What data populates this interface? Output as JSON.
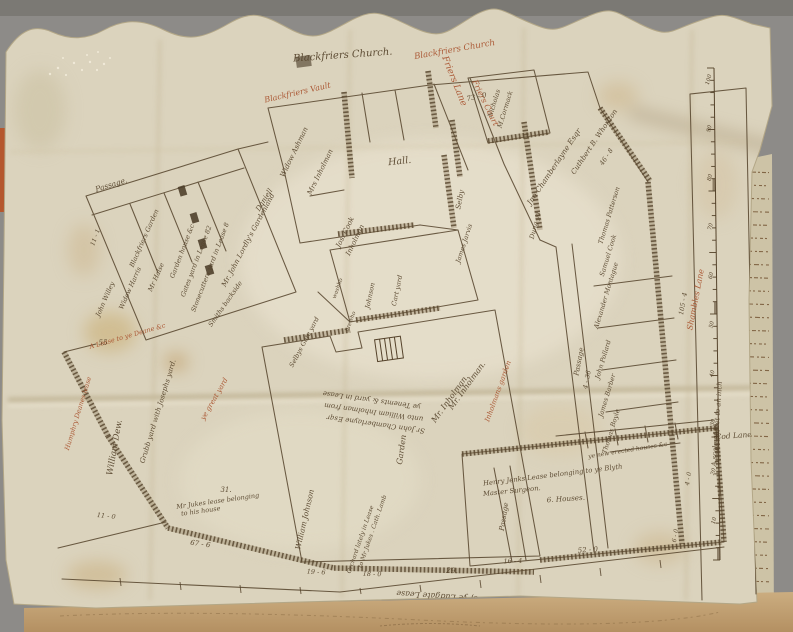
{
  "palette": {
    "backdrop": "#8d8b88",
    "backdrop_top": "#7b7974",
    "parchment": "#dbd3bd",
    "parchment_light": "#e9e2cf",
    "ink": "#54422a",
    "red": "#a8502c",
    "manuscript_paper": "#cdc3a6",
    "manuscript_ink": "#6a4826",
    "bottom_strip": "#c2a377",
    "red_sliver": "#b5572e"
  },
  "map": {
    "title": "Blackfriers Church.",
    "scale_bar": {
      "caption": "A scale of feet to an inch",
      "numbers": [
        "100",
        "90",
        "80",
        "70",
        "60",
        "50",
        "40",
        "30",
        "20",
        "10"
      ]
    },
    "labels": [
      {
        "id": "blackfriers-church-title",
        "text": "Blackfriers Church.",
        "x": 343,
        "y": 58,
        "r": -4,
        "s": 10,
        "c": "ink"
      },
      {
        "id": "blackfriers-vault-red",
        "text": "Blackfriers Vault",
        "x": 298,
        "y": 95,
        "r": -13,
        "s": 8,
        "c": "red"
      },
      {
        "id": "blackfriers-church-red",
        "text": "Blackfriers Church",
        "x": 455,
        "y": 52,
        "r": -10,
        "s": 8.5,
        "c": "red"
      },
      {
        "id": "friers-lane-red",
        "text": "Friers Lane",
        "x": 452,
        "y": 82,
        "r": 68,
        "s": 9,
        "c": "red"
      },
      {
        "id": "friers-court-red",
        "text": "Friers Court",
        "x": 483,
        "y": 104,
        "r": 64,
        "s": 8,
        "c": "red"
      },
      {
        "id": "hall-label",
        "text": "Hall.",
        "x": 400,
        "y": 164,
        "r": -6,
        "s": 9.5,
        "c": "ink"
      },
      {
        "id": "passage-top",
        "text": "Passage.",
        "x": 112,
        "y": 187,
        "r": -17,
        "s": 7.5,
        "c": "ink"
      },
      {
        "id": "measure-73-0",
        "text": "73 - 0",
        "x": 477,
        "y": 99,
        "r": -12,
        "s": 7,
        "c": "ink"
      },
      {
        "id": "nicholas",
        "text": "Nicholas",
        "x": 496,
        "y": 104,
        "r": -73,
        "s": 6.5,
        "c": "ink"
      },
      {
        "id": "mccormack",
        "text": "M.Cormack",
        "x": 507,
        "y": 110,
        "r": -73,
        "s": 6.5,
        "c": "ink"
      },
      {
        "id": "widow-ashman",
        "text": "Widow Ashman",
        "x": 296,
        "y": 153,
        "r": -64,
        "s": 7,
        "c": "ink"
      },
      {
        "id": "mrs-inholman",
        "text": "Mrs Inholman",
        "x": 322,
        "y": 173,
        "r": -64,
        "s": 7,
        "c": "ink"
      },
      {
        "id": "jos-cook",
        "text": "Jos. Cook",
        "x": 347,
        "y": 233,
        "r": -64,
        "s": 7,
        "c": "ink"
      },
      {
        "id": "inholman-2",
        "text": "Inholman",
        "x": 357,
        "y": 241,
        "r": -64,
        "s": 7,
        "c": "ink"
      },
      {
        "id": "blackfriers-garden",
        "text": "Blackfriers Garden",
        "x": 146,
        "y": 239,
        "r": -66,
        "s": 6.5,
        "c": "ink"
      },
      {
        "id": "room-willey",
        "text": "John Willey",
        "x": 107,
        "y": 300,
        "r": -66,
        "s": 6.5,
        "c": "ink"
      },
      {
        "id": "room-harris",
        "text": "Widow Harris",
        "x": 132,
        "y": 289,
        "r": -66,
        "s": 6.5,
        "c": "ink"
      },
      {
        "id": "room-halse",
        "text": "Mr Halse",
        "x": 158,
        "y": 278,
        "r": -66,
        "s": 6.5,
        "c": "ink"
      },
      {
        "id": "strip-gardenhouse",
        "text": "Garden house &c",
        "x": 184,
        "y": 252,
        "r": -69,
        "s": 6.5,
        "c": "ink"
      },
      {
        "id": "strip-gatesyard",
        "text": "Gates yard in Lease 82",
        "x": 198,
        "y": 262,
        "r": -69,
        "s": 6.5,
        "c": "ink"
      },
      {
        "id": "strip-stonecutters",
        "text": "Stonecutters yard in Lease 8",
        "x": 212,
        "y": 268,
        "r": -69,
        "s": 6.5,
        "c": "ink"
      },
      {
        "id": "lordly-gardenland",
        "text": "Mr. John Lordly's Gardenland",
        "x": 250,
        "y": 241,
        "r": -62,
        "s": 7,
        "c": "ink"
      },
      {
        "id": "daniell",
        "text": "Daniell",
        "x": 266,
        "y": 201,
        "r": -58,
        "s": 7,
        "c": "ink"
      },
      {
        "id": "measure-11-1",
        "text": "11 - 1",
        "x": 97,
        "y": 238,
        "r": -70,
        "s": 6,
        "c": "ink"
      },
      {
        "id": "chamberlayne",
        "text": "Jno Chamberlayne Esqr",
        "x": 556,
        "y": 168,
        "r": -56,
        "s": 7.5,
        "c": "ink"
      },
      {
        "id": "whorlton",
        "text": "Cuthbert B. Whorlton",
        "x": 596,
        "y": 143,
        "r": -56,
        "s": 7,
        "c": "ink"
      },
      {
        "id": "measure-46-8",
        "text": "46 - 8",
        "x": 608,
        "y": 158,
        "r": -56,
        "s": 6.5,
        "c": "ink"
      },
      {
        "id": "dung-yard",
        "text": "Dung yd",
        "x": 537,
        "y": 226,
        "r": -76,
        "s": 6.5,
        "c": "ink"
      },
      {
        "id": "selby",
        "text": "Selby",
        "x": 462,
        "y": 200,
        "r": -80,
        "s": 7,
        "c": "ink"
      },
      {
        "id": "james-jarvis",
        "text": "James Jarvis",
        "x": 466,
        "y": 244,
        "r": -72,
        "s": 6.5,
        "c": "ink"
      },
      {
        "id": "johnson",
        "text": "Johnson",
        "x": 372,
        "y": 296,
        "r": -78,
        "s": 6.5,
        "c": "ink"
      },
      {
        "id": "cart-yard",
        "text": "Cart yard",
        "x": 399,
        "y": 291,
        "r": -78,
        "s": 6.5,
        "c": "ink"
      },
      {
        "id": "washhouse",
        "text": "washho",
        "x": 339,
        "y": 289,
        "r": -70,
        "s": 5.5,
        "c": "ink"
      },
      {
        "id": "brewhouse",
        "text": "brewho",
        "x": 352,
        "y": 322,
        "r": -70,
        "s": 5.5,
        "c": "ink"
      },
      {
        "id": "gate-yard",
        "text": "Selbys Gate yard",
        "x": 306,
        "y": 343,
        "r": -62,
        "s": 6.5,
        "c": "ink"
      },
      {
        "id": "smiths-backside",
        "text": "Smiths backside",
        "x": 227,
        "y": 305,
        "r": -55,
        "s": 6.5,
        "c": "ink"
      },
      {
        "id": "lease-deane-red",
        "text": "A Lease to ye Deane &c",
        "x": 128,
        "y": 338,
        "r": -16,
        "s": 6.5,
        "c": "red"
      },
      {
        "id": "measure-55",
        "text": "55",
        "x": 103,
        "y": 345,
        "r": 0,
        "s": 7,
        "c": "ink"
      },
      {
        "id": "humphry-red",
        "text": "Humphry Deanes lease",
        "x": 80,
        "y": 414,
        "r": -73,
        "s": 6.5,
        "c": "red"
      },
      {
        "id": "william-dew",
        "text": "William Dew.",
        "x": 117,
        "y": 448,
        "r": -80,
        "s": 8.5,
        "c": "ink"
      },
      {
        "id": "grubb-yard",
        "text": "Grubb yard with Josephs yard.",
        "x": 160,
        "y": 412,
        "r": -73,
        "s": 7,
        "c": "ink"
      },
      {
        "id": "great-yard-red",
        "text": "ye great yard",
        "x": 216,
        "y": 400,
        "r": -60,
        "s": 7,
        "c": "red"
      },
      {
        "id": "measure-11-0",
        "text": "11 - 0",
        "x": 106,
        "y": 518,
        "r": 6,
        "s": 6.5,
        "c": "ink"
      },
      {
        "id": "jukes-lease-1",
        "text": "Mr Jukes lease belonging",
        "x": 218,
        "y": 503,
        "r": -8,
        "s": 6.5,
        "c": "ink"
      },
      {
        "id": "jukes-lease-2",
        "text": "to his house",
        "x": 201,
        "y": 513,
        "r": -8,
        "s": 6.5,
        "c": "ink"
      },
      {
        "id": "measure-31",
        "text": "31.",
        "x": 226,
        "y": 492,
        "r": 0,
        "s": 7,
        "c": "ink"
      },
      {
        "id": "garden-vertical",
        "text": "Garden",
        "x": 404,
        "y": 450,
        "r": -82,
        "s": 8,
        "c": "ink"
      },
      {
        "id": "mr-inholman-a",
        "text": "Mr. Inholman.",
        "x": 452,
        "y": 400,
        "r": -54,
        "s": 8,
        "c": "ink"
      },
      {
        "id": "mr-inholman-b",
        "text": "Mr. Inholman.",
        "x": 469,
        "y": 387,
        "r": -54,
        "s": 8,
        "c": "ink"
      },
      {
        "id": "inholmans-garden-red",
        "text": "Inholmans garden",
        "x": 500,
        "y": 392,
        "r": -70,
        "s": 7,
        "c": "red"
      },
      {
        "id": "deed-line-1",
        "text": "ye Tenemts & yard in Lease",
        "x": 372,
        "y": 398,
        "r": 188,
        "s": 7,
        "c": "ink"
      },
      {
        "id": "deed-line-2",
        "text": "unto William Inholman from",
        "x": 374,
        "y": 410,
        "r": 188,
        "s": 7,
        "c": "ink"
      },
      {
        "id": "deed-line-3",
        "text": "Sr John Chamberlayne Esqr",
        "x": 376,
        "y": 422,
        "r": 188,
        "s": 7,
        "c": "ink"
      },
      {
        "id": "william-johnson",
        "text": "William Johnson",
        "x": 307,
        "y": 520,
        "r": -77,
        "s": 7.5,
        "c": "ink"
      },
      {
        "id": "passage-bottom",
        "text": "Passage",
        "x": 506,
        "y": 517,
        "r": -81,
        "s": 7,
        "c": "ink"
      },
      {
        "id": "passage-right",
        "text": "Passage",
        "x": 581,
        "y": 362,
        "r": -79,
        "s": 7,
        "c": "ink"
      },
      {
        "id": "measure-4-36",
        "text": "4 - 36",
        "x": 589,
        "y": 380,
        "r": -79,
        "s": 6.5,
        "c": "ink"
      },
      {
        "id": "thomas-patterson",
        "text": "Thomas Patterson",
        "x": 611,
        "y": 216,
        "r": -73,
        "s": 6.5,
        "c": "ink"
      },
      {
        "id": "samuel-cook",
        "text": "Samuel Cook",
        "x": 610,
        "y": 256,
        "r": -73,
        "s": 6.5,
        "c": "ink"
      },
      {
        "id": "alexander-montague",
        "text": "Alexander Montague",
        "x": 608,
        "y": 296,
        "r": -73,
        "s": 6.5,
        "c": "ink"
      },
      {
        "id": "john-pollard",
        "text": "John Pollard",
        "x": 605,
        "y": 360,
        "r": -73,
        "s": 6.5,
        "c": "ink"
      },
      {
        "id": "james-barber",
        "text": "James Barber",
        "x": 609,
        "y": 396,
        "r": -73,
        "s": 6.5,
        "c": "ink"
      },
      {
        "id": "thomas-boyle",
        "text": "Thomas Boyle",
        "x": 613,
        "y": 432,
        "r": -73,
        "s": 6.5,
        "c": "ink"
      },
      {
        "id": "shambles-lane-red",
        "text": "Shambles Lane",
        "x": 698,
        "y": 300,
        "r": -79,
        "s": 8,
        "c": "red"
      },
      {
        "id": "measure-105-4",
        "text": "105 - 4",
        "x": 685,
        "y": 304,
        "r": -80,
        "s": 6.5,
        "c": "ink"
      },
      {
        "id": "orchard-1",
        "text": "Orchard lately in Lease",
        "x": 362,
        "y": 540,
        "r": -71,
        "s": 6,
        "c": "ink"
      },
      {
        "id": "orchard-2",
        "text": "to Mr Jukes . Cath. Lamb",
        "x": 374,
        "y": 532,
        "r": -71,
        "s": 6,
        "c": "ink"
      },
      {
        "id": "jenks-1",
        "text": "Henry Jenks Lease belonging to ye Blyth",
        "x": 553,
        "y": 477,
        "r": -7,
        "s": 6.8,
        "c": "ink"
      },
      {
        "id": "jenks-2",
        "text": "Master Surgeon.",
        "x": 512,
        "y": 493,
        "r": -6,
        "s": 6.8,
        "c": "ink"
      },
      {
        "id": "jenks-3",
        "text": "6. Houses.",
        "x": 566,
        "y": 501,
        "r": -4,
        "s": 7.2,
        "c": "ink"
      },
      {
        "id": "new-houses",
        "text": "ye new erected houses &c",
        "x": 628,
        "y": 452,
        "r": -9,
        "s": 6,
        "c": "ink"
      },
      {
        "id": "measure-67-6",
        "text": "67 - 6",
        "x": 200,
        "y": 546,
        "r": 8,
        "s": 7,
        "c": "ink"
      },
      {
        "id": "measure-19-6",
        "text": "19 - 6",
        "x": 316,
        "y": 574,
        "r": 3,
        "s": 6.5,
        "c": "ink"
      },
      {
        "id": "measure-18-0",
        "text": "18 - 0",
        "x": 372,
        "y": 576,
        "r": 2,
        "s": 6.5,
        "c": "ink"
      },
      {
        "id": "measure-29",
        "text": "29.",
        "x": 452,
        "y": 573,
        "r": 2,
        "s": 7.5,
        "c": "ink"
      },
      {
        "id": "measure-16-4",
        "text": "16 - 4",
        "x": 513,
        "y": 563,
        "r": -2,
        "s": 6.5,
        "c": "ink"
      },
      {
        "id": "measure-52-0",
        "text": "52 - 0",
        "x": 588,
        "y": 552,
        "r": -4,
        "s": 7,
        "c": "ink"
      },
      {
        "id": "measure-4-0",
        "text": "4 - 0",
        "x": 690,
        "y": 479,
        "r": -80,
        "s": 6,
        "c": "ink"
      },
      {
        "id": "measure-6-0",
        "text": "6 - 0",
        "x": 677,
        "y": 536,
        "r": -80,
        "s": 6,
        "c": "ink"
      },
      {
        "id": "cod-lane",
        "text": "Cod Lane.",
        "x": 735,
        "y": 438,
        "r": -4,
        "s": 7.5,
        "c": "ink"
      },
      {
        "id": "scale-caption",
        "text": "A scale of feet to an inch",
        "x": 719,
        "y": 424,
        "r": -86,
        "s": 6.8,
        "c": "ink"
      },
      {
        "id": "bottom-inscription",
        "text": "Jo: 6: 85 - of ye Ludgate Lease",
        "x": 458,
        "y": 595,
        "r": 184,
        "s": 8,
        "c": "ink"
      }
    ]
  }
}
